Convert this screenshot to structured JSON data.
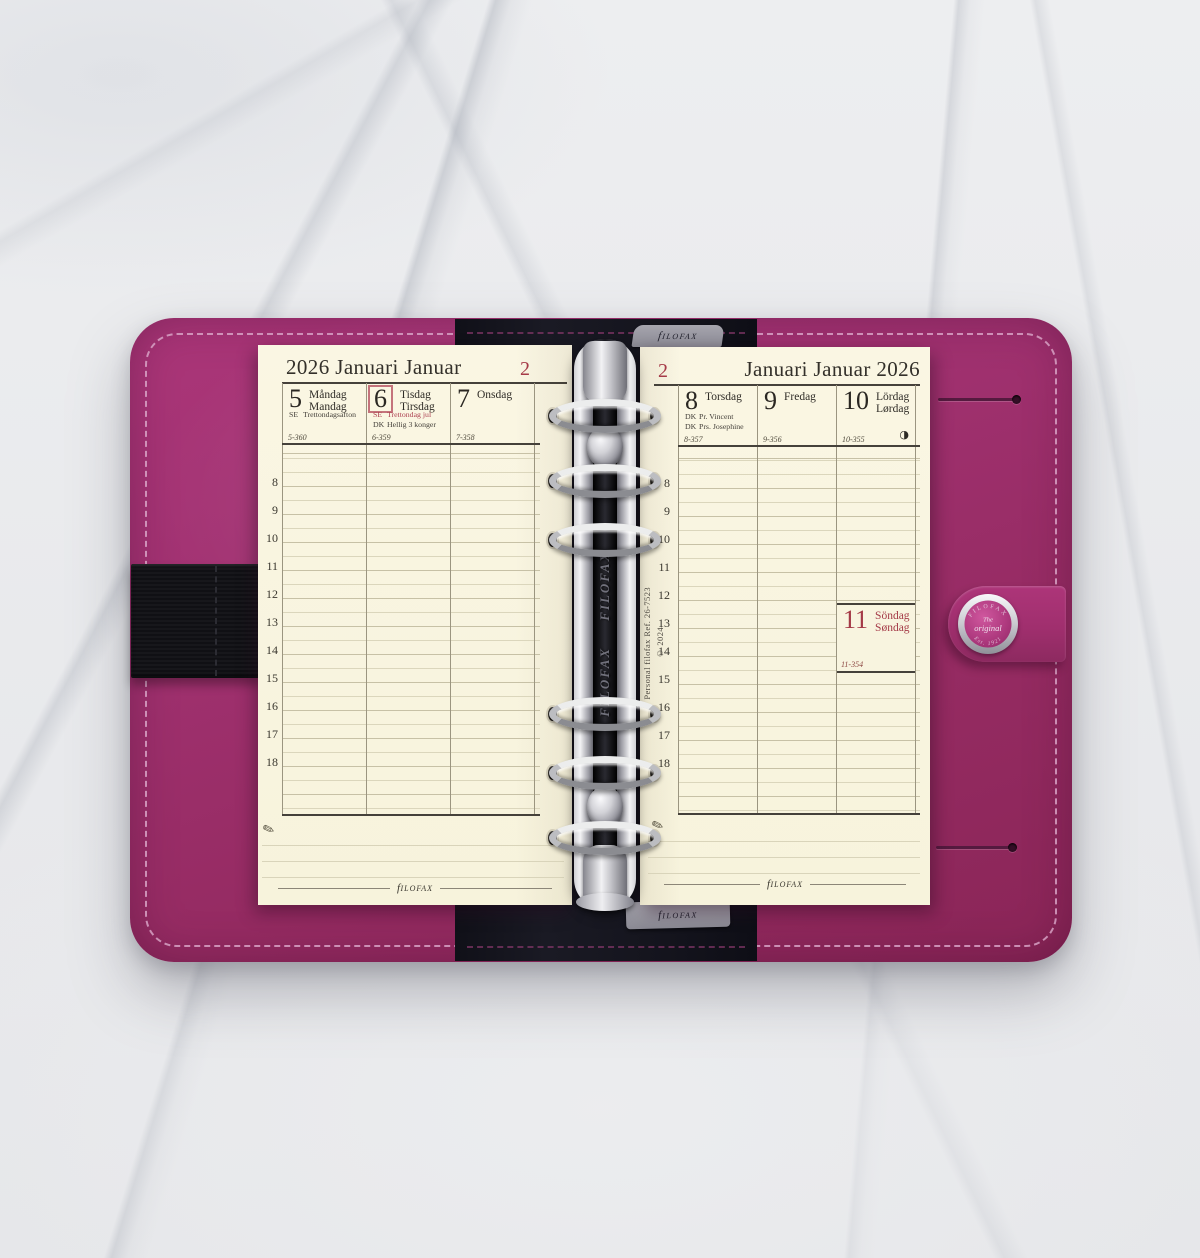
{
  "scene": {
    "brand_f": "f",
    "brand_rest": "ilofax",
    "spine": {
      "brand_repeat_1": "FILOFAX",
      "brand_repeat_2": "FILOFAX",
      "ref_line1": "Personal filofax Ref. 26-7523",
      "ref_line2": "© 2024"
    },
    "button": {
      "arc_top": "FILOFAX",
      "line1": "The",
      "line2": "original",
      "arc_bottom": "Est. 1921"
    },
    "pen_icon": "✎",
    "moon_icon": "◑"
  },
  "left_page": {
    "title": "2026 Januari Januar",
    "week_number": "2",
    "days": [
      {
        "num": "5",
        "name1": "Måndag",
        "name2": "Mandag",
        "hol1_code": "SE",
        "hol1_text": "Trettondagsafton",
        "footer": "5-360"
      },
      {
        "num": "6",
        "name1": "Tisdag",
        "name2": "Tirsdag",
        "hol1_code": "SE",
        "hol1_text": "Trettondag jul",
        "hol2_code": "DK",
        "hol2_text": "Hellig 3 konger",
        "footer": "6-359"
      },
      {
        "num": "7",
        "name1": "Onsdag",
        "footer": "7-358"
      }
    ],
    "hours": [
      "8",
      "9",
      "10",
      "11",
      "12",
      "13",
      "14",
      "15",
      "16",
      "17",
      "18"
    ]
  },
  "right_page": {
    "title": "Januari Januar 2026",
    "week_number": "2",
    "days": [
      {
        "num": "8",
        "name1": "Torsdag",
        "hol1_code": "DK",
        "hol1_text": "Pr. Vincent",
        "hol2_code": "DK",
        "hol2_text": "Prs. Josephine",
        "footer": "8-357"
      },
      {
        "num": "9",
        "name1": "Fredag",
        "footer": "9-356"
      },
      {
        "num": "10",
        "name1": "Lördag",
        "name2": "Lørdag",
        "footer": "10-355"
      }
    ],
    "sunday": {
      "num": "11",
      "name1": "Söndag",
      "name2": "Søndag",
      "footer": "11-354"
    },
    "hours": [
      "8",
      "9",
      "10",
      "11",
      "12",
      "13",
      "14",
      "15",
      "16",
      "17",
      "18"
    ]
  }
}
